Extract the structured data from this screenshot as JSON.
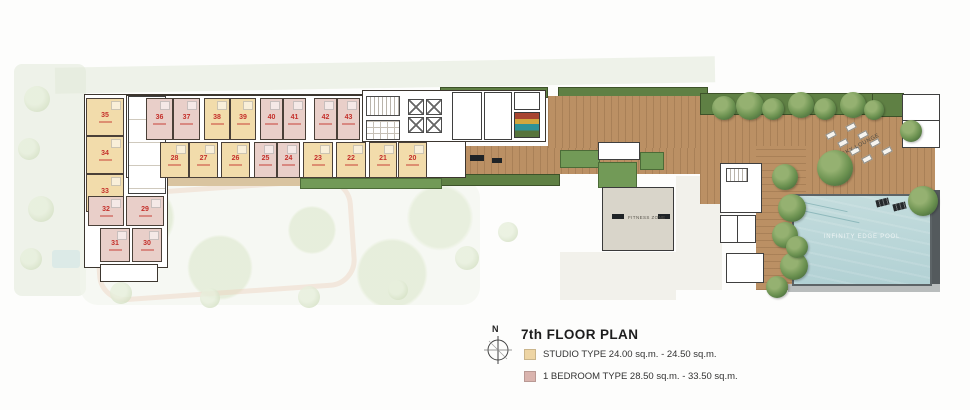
{
  "title": "7th FLOOR PLAN",
  "compass_label": "N",
  "legend": {
    "studio": {
      "label": "STUDIO TYPE 24.00 sq.m. - 24.50 sq.m.",
      "swatch": "#eed5a4"
    },
    "one_bedroom": {
      "label": "1 BEDROOM TYPE 28.50 sq.m. - 33.50 sq.m.",
      "swatch": "#dab4ae"
    }
  },
  "plan_labels": {
    "fitness_zone": "FITNESS ZONE",
    "sky_lounge": "SKY LOUNGE",
    "infinity_pool": "INFINITY EDGE POOL"
  },
  "colors": {
    "studio_fill": "#f2dcab",
    "one_bedroom_fill": "#e9cfc9",
    "unit_number": "#c4302b",
    "wood_deck": "#bb9064",
    "landscape_green": "#5f8044",
    "pool_water": "#bed9da"
  },
  "units": {
    "u20": {
      "num": "20",
      "type": "studio"
    },
    "u21": {
      "num": "21",
      "type": "studio"
    },
    "u22": {
      "num": "22",
      "type": "studio"
    },
    "u23": {
      "num": "23",
      "type": "studio"
    },
    "u24": {
      "num": "24",
      "type": "one_bedroom"
    },
    "u25": {
      "num": "25",
      "type": "one_bedroom"
    },
    "u26": {
      "num": "26",
      "type": "studio"
    },
    "u27": {
      "num": "27",
      "type": "studio"
    },
    "u28": {
      "num": "28",
      "type": "studio"
    },
    "u29": {
      "num": "29",
      "type": "one_bedroom"
    },
    "u30": {
      "num": "30",
      "type": "one_bedroom"
    },
    "u31": {
      "num": "31",
      "type": "one_bedroom"
    },
    "u32": {
      "num": "32",
      "type": "one_bedroom"
    },
    "u33": {
      "num": "33",
      "type": "studio"
    },
    "u34": {
      "num": "34",
      "type": "studio"
    },
    "u35": {
      "num": "35",
      "type": "studio"
    },
    "u36": {
      "num": "36",
      "type": "one_bedroom"
    },
    "u37": {
      "num": "37",
      "type": "one_bedroom"
    },
    "u38": {
      "num": "38",
      "type": "studio"
    },
    "u39": {
      "num": "39",
      "type": "studio"
    },
    "u40": {
      "num": "40",
      "type": "one_bedroom"
    },
    "u41": {
      "num": "41",
      "type": "one_bedroom"
    },
    "u42": {
      "num": "42",
      "type": "one_bedroom"
    },
    "u43": {
      "num": "43",
      "type": "one_bedroom"
    }
  }
}
